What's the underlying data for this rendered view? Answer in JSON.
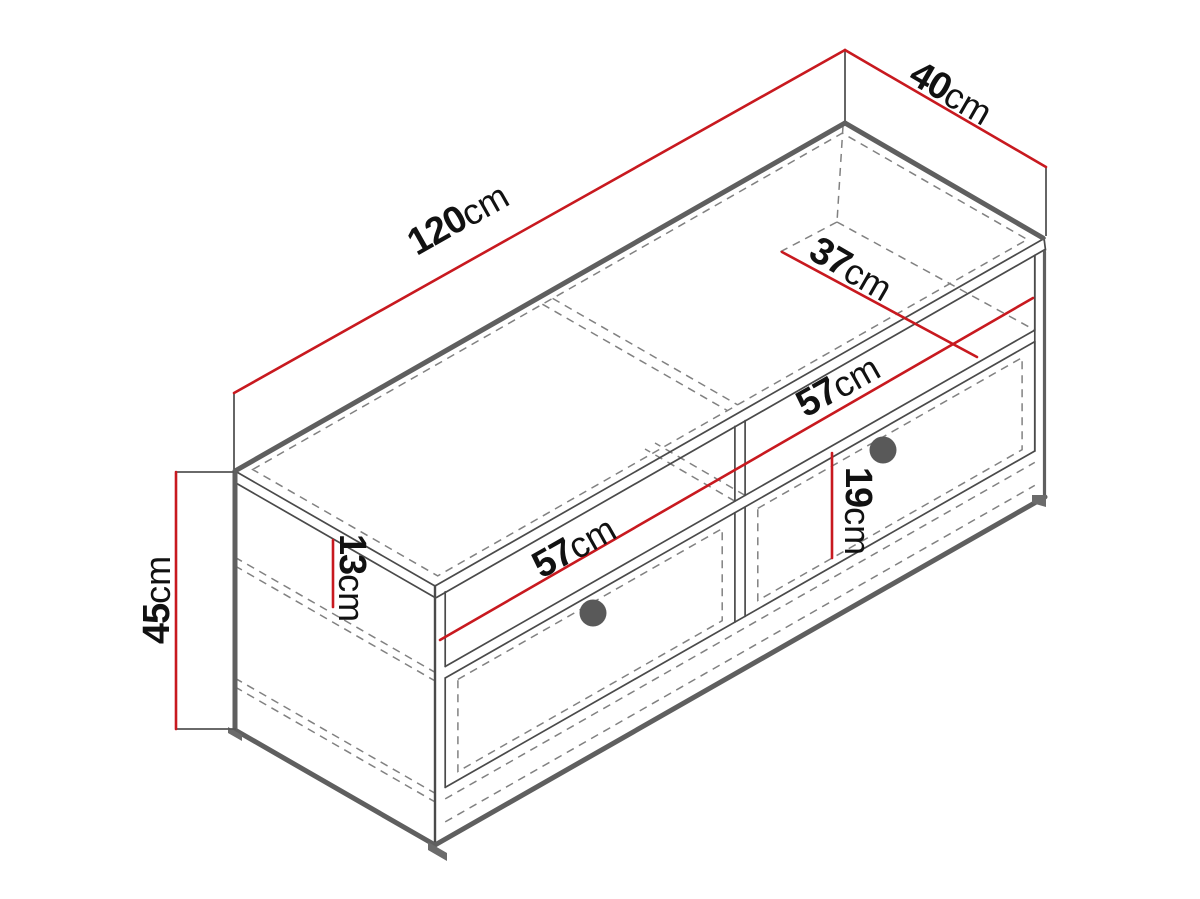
{
  "diagram": {
    "kind": "furniture-dimension-drawing",
    "unit": "cm"
  },
  "dimensions": {
    "width": {
      "value": "120",
      "unit": "cm"
    },
    "depth": {
      "value": "40",
      "unit": "cm"
    },
    "interior_depth": {
      "value": "37",
      "unit": "cm"
    },
    "right_section": {
      "value": "57",
      "unit": "cm"
    },
    "left_section": {
      "value": "57",
      "unit": "cm"
    },
    "drawer_height": {
      "value": "19",
      "unit": "cm"
    },
    "niche_height": {
      "value": "13",
      "unit": "cm"
    },
    "total_height": {
      "value": "45",
      "unit": "cm"
    }
  },
  "colors": {
    "dimension_line": "#c8191f",
    "outline": "#5f5f5f",
    "line": "#4a4a4a",
    "hidden": "#818181",
    "extension": "#555555",
    "knob": "#595959",
    "label": "#111111",
    "background": "#ffffff"
  }
}
